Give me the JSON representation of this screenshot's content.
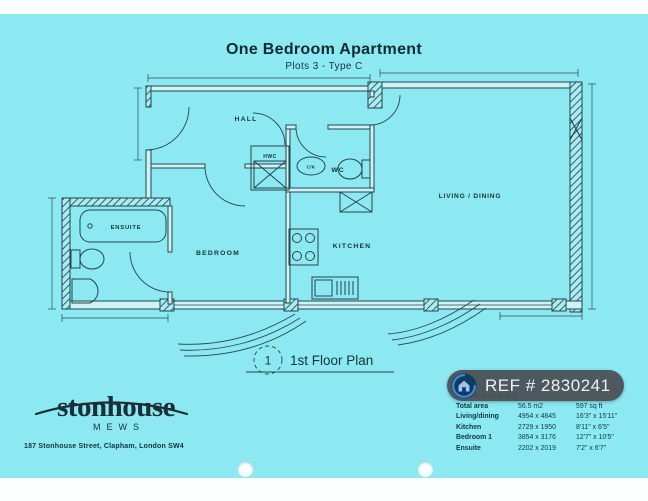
{
  "page": {
    "title": "One Bedroom Apartment",
    "subtitle": "Plots 3 - Type C"
  },
  "plan": {
    "rooms": {
      "hall": "HALL",
      "wc": "WC",
      "hwc": "HWC",
      "ck": "C/K",
      "bedroom": "BEDROOM",
      "kitchen": "KITCHEN",
      "living": "LIVING / DINING",
      "ensuite": "ENSUITE"
    },
    "floor_marker": {
      "number": "1",
      "label": "1st Floor Plan"
    }
  },
  "branding": {
    "name": "stonhouse",
    "tagline": "MEWS",
    "address": "187 Stonhouse Street, Clapham, London SW4"
  },
  "ref_badge": {
    "text": "REF # 2830241",
    "icon": "house-icon"
  },
  "dimensions": {
    "title": "DIMENSIONS",
    "rows": [
      {
        "name": "Total area",
        "metric": "56.5 m2",
        "imperial": "597 sq ft"
      },
      {
        "name": "Living/dining",
        "metric": "4954 x 4845",
        "imperial": "16'3\" x 15'11\""
      },
      {
        "name": "Kitchen",
        "metric": "2729 x 1950",
        "imperial": "8'11\" x 6'5\""
      },
      {
        "name": "Bedroom 1",
        "metric": "3854 x 3176",
        "imperial": "12'7\" x 10'5\""
      },
      {
        "name": "Ensuite",
        "metric": "2202 x 2019",
        "imperial": "7'2\" x 6'7\""
      }
    ]
  },
  "colors": {
    "paper": "#8de9f1",
    "ink": "#24454f",
    "badge_bg": "#4a5155",
    "badge_text": "#eef1f2",
    "logo_blue": "#3f8bd8"
  }
}
